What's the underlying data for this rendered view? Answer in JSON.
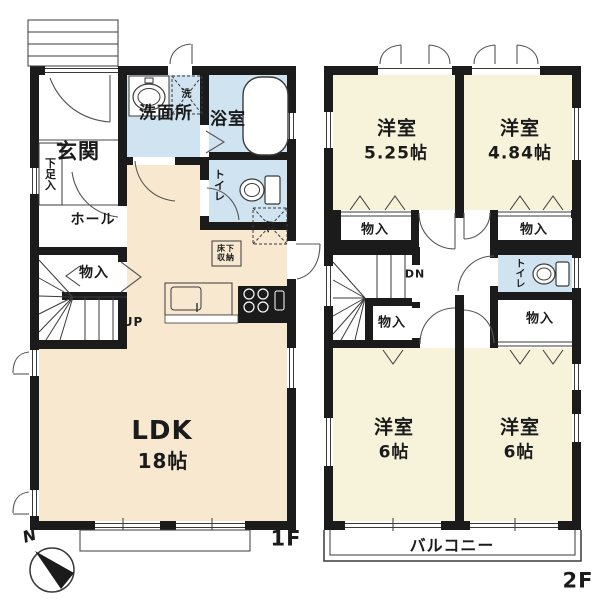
{
  "title": "間取り図",
  "colors": {
    "wall": "#1b1b1b",
    "floor1_room": "#f8e8d0",
    "floor2_room": "#f6f3da",
    "wet_room": "#cfe4f0",
    "line": "#3a3a3a"
  },
  "floor1": {
    "name": "1F",
    "rooms": {
      "entrance": "玄関",
      "shoe_box": "下足入",
      "hall": "ホール",
      "closet": "物入",
      "stairs_up": "UP",
      "washroom": "洗面所",
      "laundry": "洗",
      "bathroom": "浴室",
      "toilet": "トイレ",
      "underfloor_l1": "床下",
      "underfloor_l2": "収納",
      "fridge": "冷",
      "ldk_name": "LDK",
      "ldk_size": "18帖"
    }
  },
  "floor2": {
    "name": "2F",
    "rooms": {
      "bedroom": "洋室",
      "bedroom1_size": "5.25帖",
      "bedroom2_size": "4.84帖",
      "bedroom34_size": "6帖",
      "closet": "物入",
      "stairs_down": "DN",
      "toilet": "トイレ",
      "balcony": "バルコニー"
    }
  },
  "compass": {
    "north": "N"
  }
}
